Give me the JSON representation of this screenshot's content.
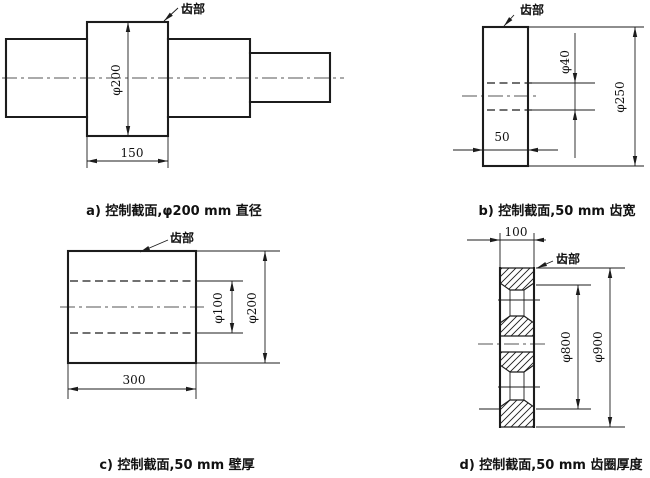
{
  "drawing": {
    "figures": {
      "a": {
        "tooth_label": "齿部",
        "dim_diameter": "φ200",
        "dim_width": "150",
        "caption": "a) 控制截面,φ200 mm 直径"
      },
      "b": {
        "tooth_label": "齿部",
        "dim_bore": "φ40",
        "dim_outer": "φ250",
        "dim_face_width": "50",
        "caption": "b) 控制截面,50 mm 齿宽"
      },
      "c": {
        "tooth_label": "齿部",
        "dim_bore": "φ100",
        "dim_outer": "φ200",
        "dim_length": "300",
        "caption": "c) 控制截面,50 mm 壁厚"
      },
      "d": {
        "tooth_label": "齿部",
        "dim_face_width": "100",
        "dim_rim_inner": "φ800",
        "dim_outer": "φ900",
        "caption": "d) 控制截面,50 mm 齿圈厚度"
      }
    },
    "colors": {
      "line": "#1c1c1c",
      "background": "#ffffff"
    }
  }
}
